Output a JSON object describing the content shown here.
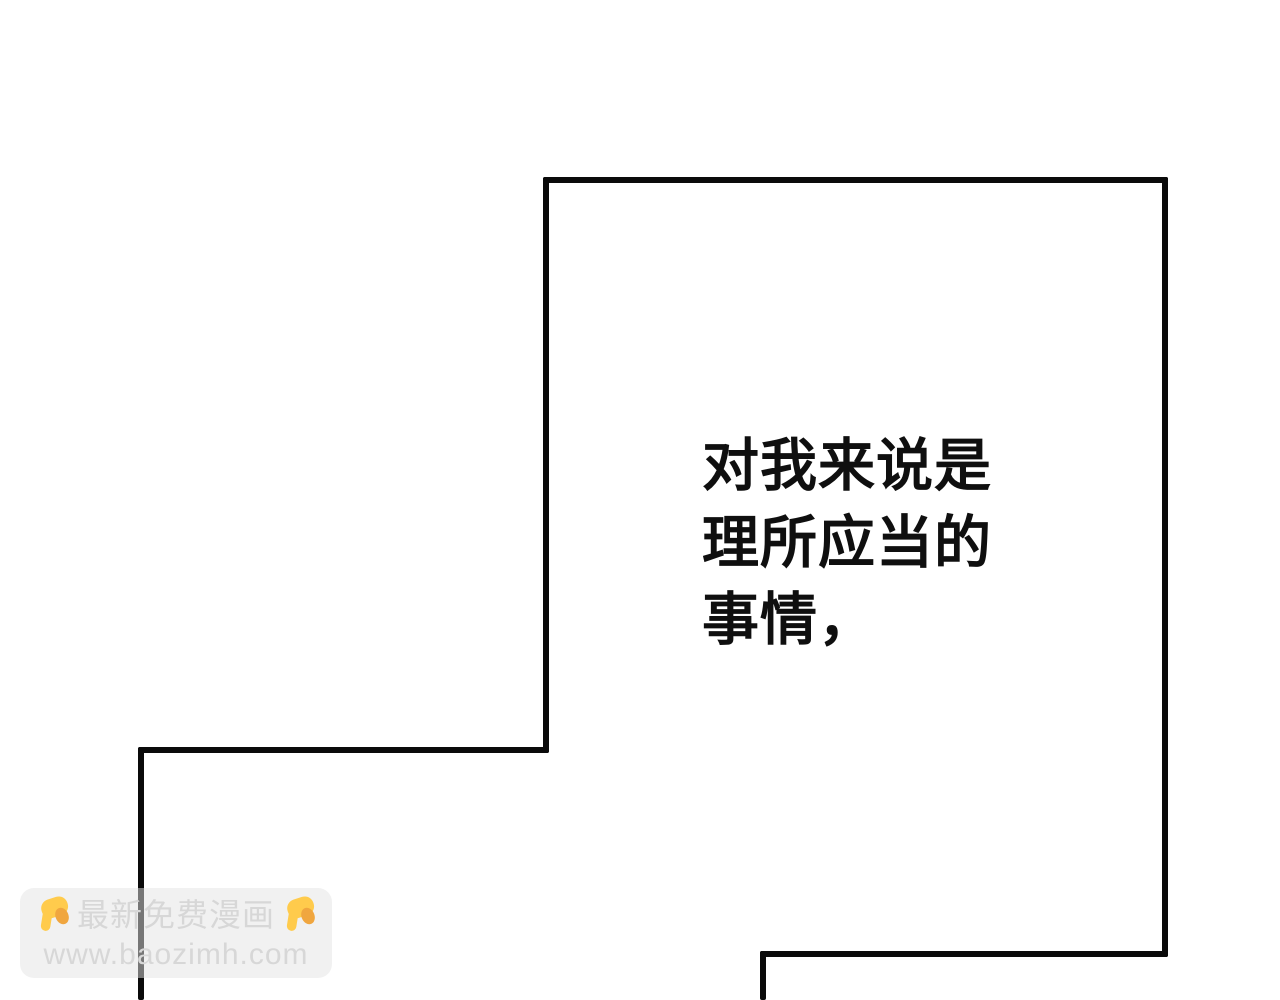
{
  "page": {
    "background_color": "#ffffff",
    "panel_border_color": "#0a0a0a"
  },
  "speech": {
    "content": "对我来说是\n理所应当的\n事情，",
    "color": "#0f0f0f"
  },
  "watermark": {
    "title": "最新免费漫画",
    "url": "www.baozimh.com",
    "text_color": "#d7d7d7",
    "emoji_name": "backhand-index-pointing-down",
    "emoji_color": "#FFCB4C",
    "emoji_shade_color": "#F0A63F"
  }
}
